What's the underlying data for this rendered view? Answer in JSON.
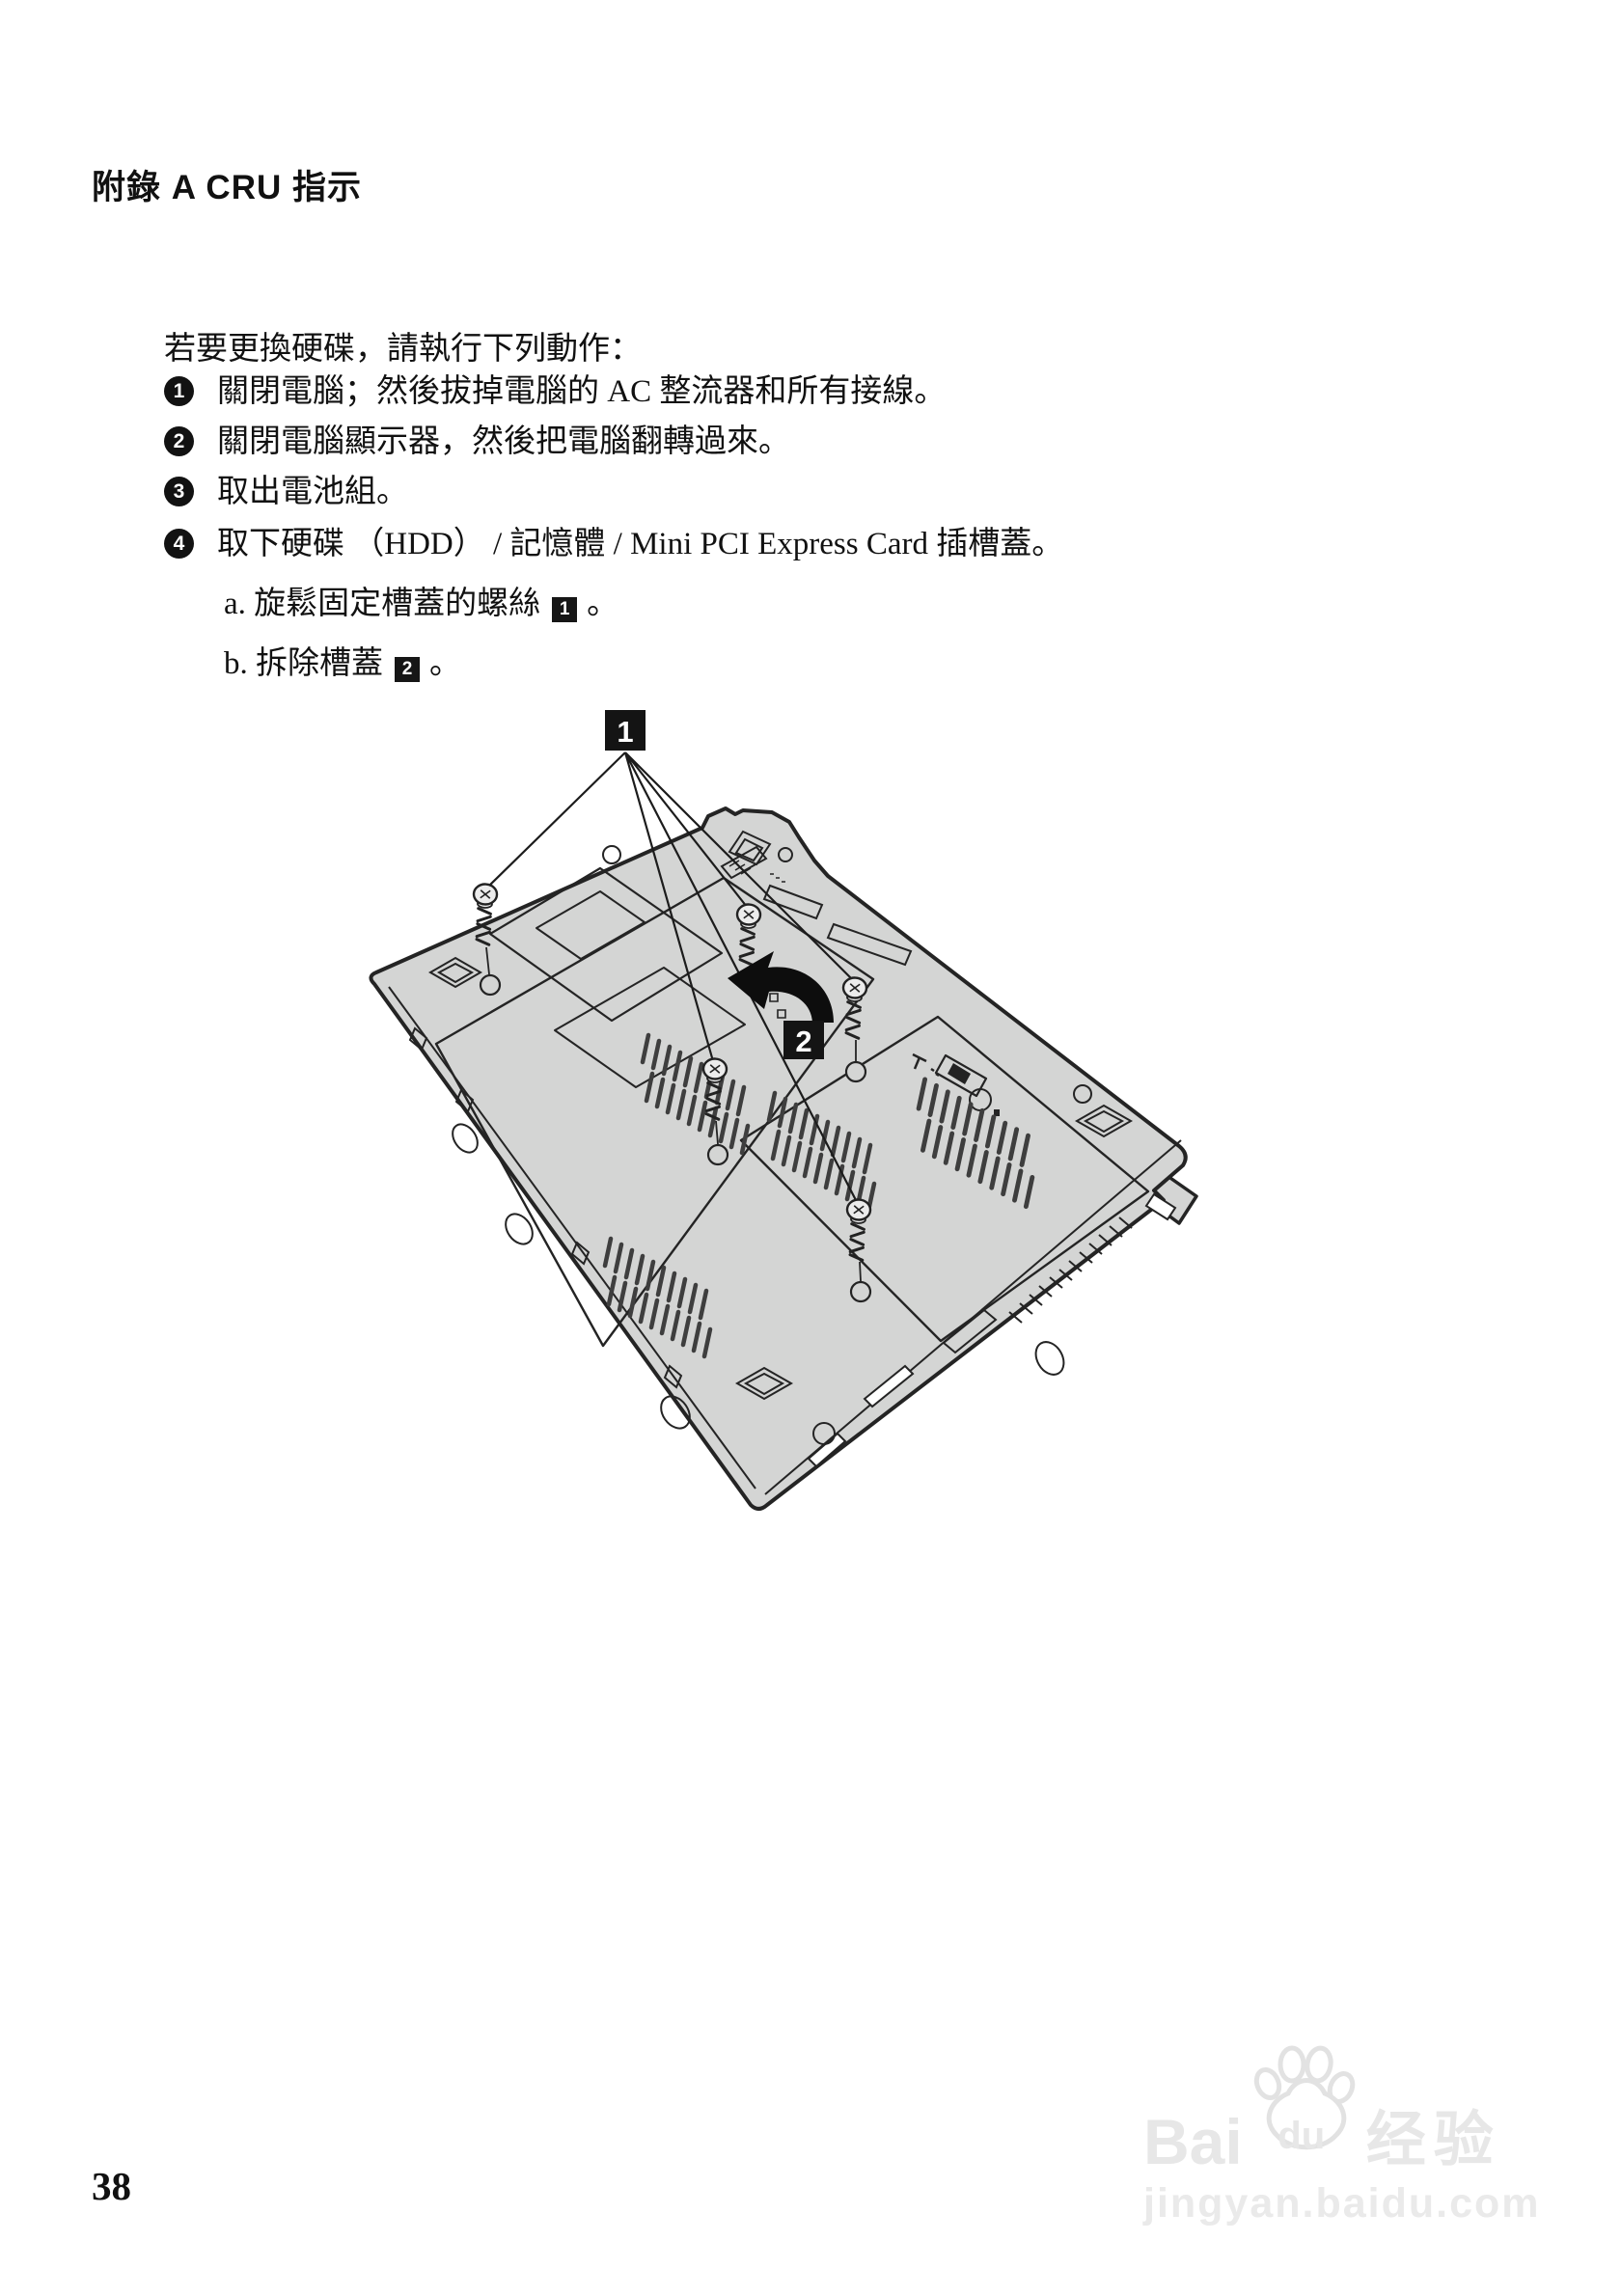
{
  "page": {
    "header": "附錄 A CRU 指示",
    "page_number": "38"
  },
  "instructions": {
    "intro": "若要更換硬碟，請執行下列動作：",
    "steps": [
      {
        "num": "1",
        "text": "關閉電腦；然後拔掉電腦的 AC 整流器和所有接線。"
      },
      {
        "num": "2",
        "text": "關閉電腦顯示器，然後把電腦翻轉過來。"
      },
      {
        "num": "3",
        "text": "取出電池組。"
      },
      {
        "num": "4",
        "text": "取下硬碟 （HDD） / 記憶體 / Mini PCI Express Card 插槽蓋。"
      }
    ],
    "substeps": [
      {
        "prefix": "a. 旋鬆固定槽蓋的螺絲",
        "marker": "1",
        "suffix": "。"
      },
      {
        "prefix": "b. 拆除槽蓋",
        "marker": "2",
        "suffix": "。"
      }
    ]
  },
  "figure": {
    "callout_1": "1",
    "callout_2": "2"
  },
  "watermark": {
    "brand_prefix": "Bai",
    "paw_text": "du",
    "brand_cjk": "经验",
    "domain": "jingyan.baidu.com"
  },
  "colors": {
    "laptop_fill": "#d4d5d4",
    "outline": "#242424",
    "label_bg": "#141414",
    "text": "#111111",
    "watermark": "#e7e7e7"
  }
}
